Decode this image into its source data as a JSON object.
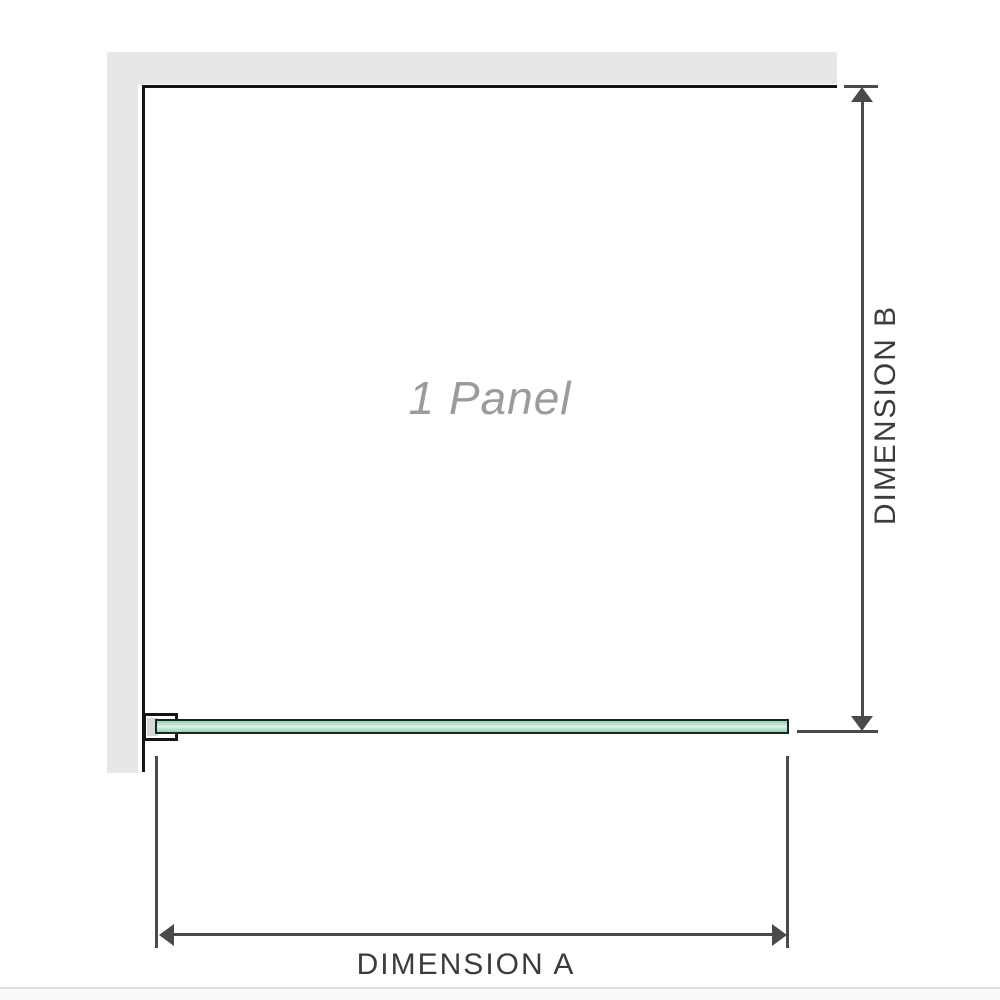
{
  "diagram": {
    "panel_label": "1 Panel",
    "dimension_a_label": "DIMENSION A",
    "dimension_b_label": "DIMENSION B"
  },
  "colors": {
    "wall": "#e7e7e7",
    "outline": "#151515",
    "dimension": "#4a4a4a",
    "dimension_text": "#3c3c3c",
    "panel_label_text": "#9b9b9b",
    "glass_border": "#16281d",
    "glass_light": "#def2e7",
    "glass_mid": "#bce4ce",
    "glass_dark": "#9bd2b3",
    "bracket_fill": "#d8d8d8",
    "footer_line": "#e1e1dd",
    "footer_bg": "#fafaf8"
  }
}
